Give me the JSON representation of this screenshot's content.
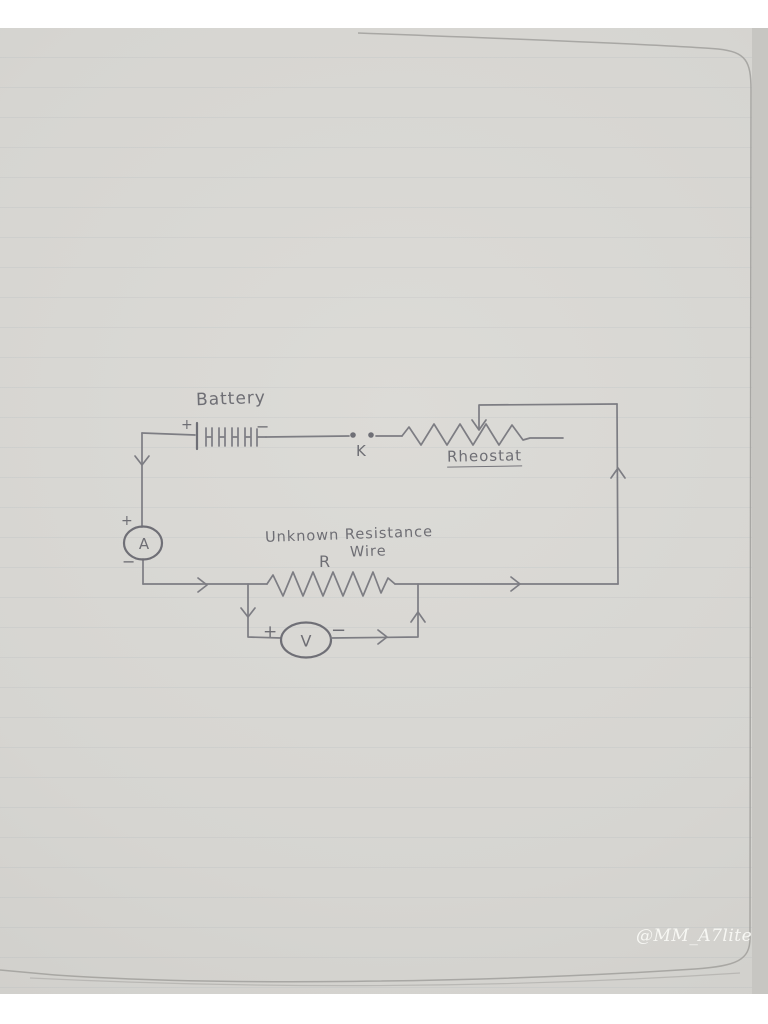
{
  "page": {
    "watermark": "@MM_A7lite"
  },
  "colors": {
    "paper": "#d6d5d1",
    "pencil": "#7d7d83",
    "handwriting": "#6e6e74",
    "watermark_text": "#faf9f5"
  },
  "diagram": {
    "battery": {
      "label": "Battery",
      "plus": "+",
      "minus": "−"
    },
    "key": {
      "label": "K"
    },
    "rheostat": {
      "label": "Rheostat"
    },
    "ammeter": {
      "letter": "A",
      "plus": "+",
      "minus": "−"
    },
    "unknown_resistance": {
      "label_line1": "Unknown Resistance",
      "label_line2": "Wire",
      "symbol": "R"
    },
    "voltmeter": {
      "letter": "V",
      "plus": "+",
      "minus": "−"
    }
  }
}
